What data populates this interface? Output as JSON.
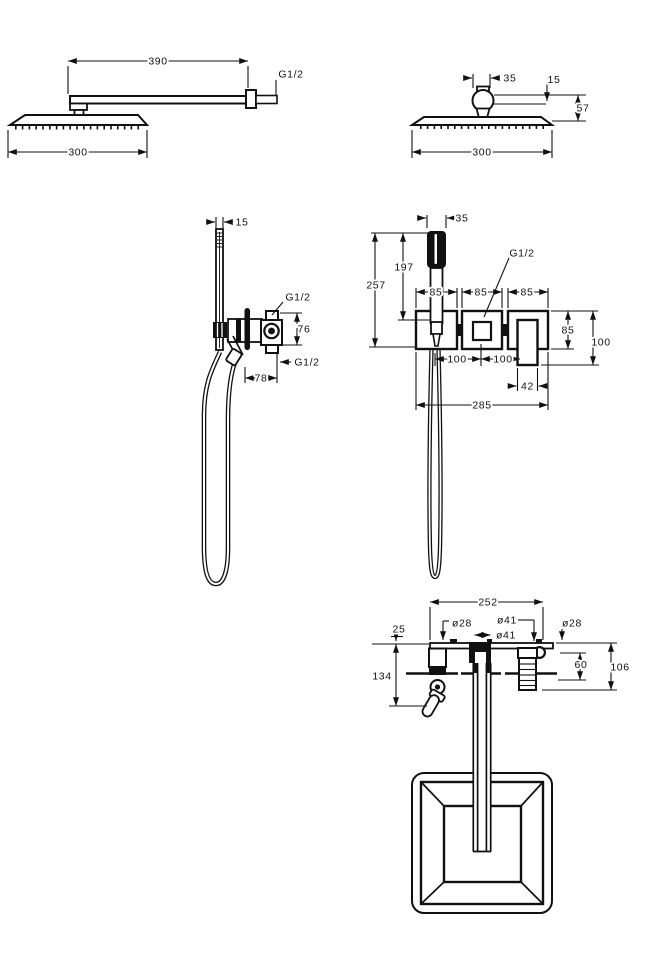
{
  "views": {
    "overhead_side": {
      "arm_length": "390",
      "thread": "G1/2",
      "head_width": "300"
    },
    "overhead_front": {
      "ball_width": "35",
      "top_offset": "15",
      "drop_height": "57",
      "head_width": "300"
    },
    "handshower_side": {
      "handset_width": "15",
      "thread_top": "G1/2",
      "outlet_height": "76",
      "thread_bottom": "G1/2",
      "outlet_offset": "78"
    },
    "mixer_front": {
      "handset_width": "35",
      "handset_length": "197",
      "overall_height": "257",
      "thread": "G1/2",
      "holder_width": "85",
      "valve_width": "85",
      "handle_block_width": "85",
      "block_height": "85",
      "handle_drop": "100",
      "spacing_left": "100",
      "spacing_right": "100",
      "handle_width": "42",
      "overall_width": "285"
    },
    "spout": {
      "overall_width": "252",
      "dia_left": "ø28",
      "dia_valve": "ø41",
      "dia_spout": "ø41",
      "dia_right": "ø28",
      "rail_offset": "25",
      "depth": "60",
      "height_right": "106",
      "height_left": "134"
    }
  }
}
